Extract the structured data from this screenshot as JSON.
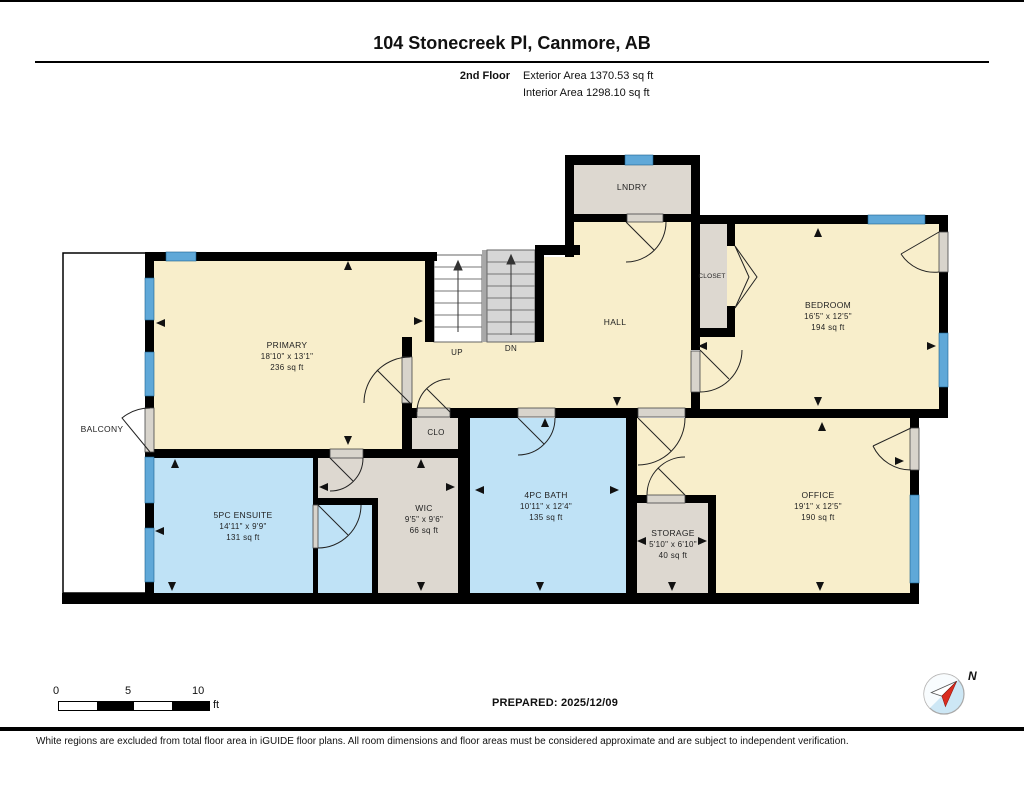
{
  "header": {
    "title": "104 Stonecreek Pl, Canmore, AB",
    "floor_label": "2nd Floor",
    "exterior_area": "Exterior Area 1370.53 sq ft",
    "interior_area": "Interior Area 1298.10 sq ft"
  },
  "rooms": {
    "lndry": {
      "name": "LNDRY"
    },
    "primary": {
      "name": "PRIMARY",
      "dims": "18'10\" x 13'1\"",
      "area": "236 sq ft"
    },
    "hall": {
      "name": "HALL"
    },
    "closet": {
      "name": "CLOSET"
    },
    "bedroom": {
      "name": "BEDROOM",
      "dims": "16'5\" x 12'5\"",
      "area": "194 sq ft"
    },
    "balcony": {
      "name": "BALCONY"
    },
    "clo": {
      "name": "CLO"
    },
    "ensuite": {
      "name": "5PC ENSUITE",
      "dims": "14'11\" x 9'9\"",
      "area": "131 sq ft"
    },
    "wic": {
      "name": "WIC",
      "dims": "9'5\" x 9'6\"",
      "area": "66 sq ft"
    },
    "bath": {
      "name": "4PC BATH",
      "dims": "10'11\" x 12'4\"",
      "area": "135 sq ft"
    },
    "storage": {
      "name": "STORAGE",
      "dims": "5'10\" x 6'10\"",
      "area": "40 sq ft"
    },
    "office": {
      "name": "OFFICE",
      "dims": "19'1\" x 12'5\"",
      "area": "190 sq ft"
    }
  },
  "stairs": {
    "up": "UP",
    "dn": "DN"
  },
  "scale": {
    "t0": "0",
    "t5": "5",
    "t10": "10",
    "unit": "ft"
  },
  "compass": {
    "label": "N"
  },
  "footer": {
    "prepared": "PREPARED: 2025/12/09",
    "disclaimer": "White regions are excluded from total floor area in iGUIDE floor plans. All room dimensions and floor areas must be considered approximate and are subject to independent verification."
  },
  "colors": {
    "room_cream": "#f8eecb",
    "room_blue": "#bfe2f6",
    "room_grey": "#ddd8d0",
    "window_blue": "#5fa8d8",
    "wall_black": "#000000",
    "compass_red": "#d92b1e"
  }
}
